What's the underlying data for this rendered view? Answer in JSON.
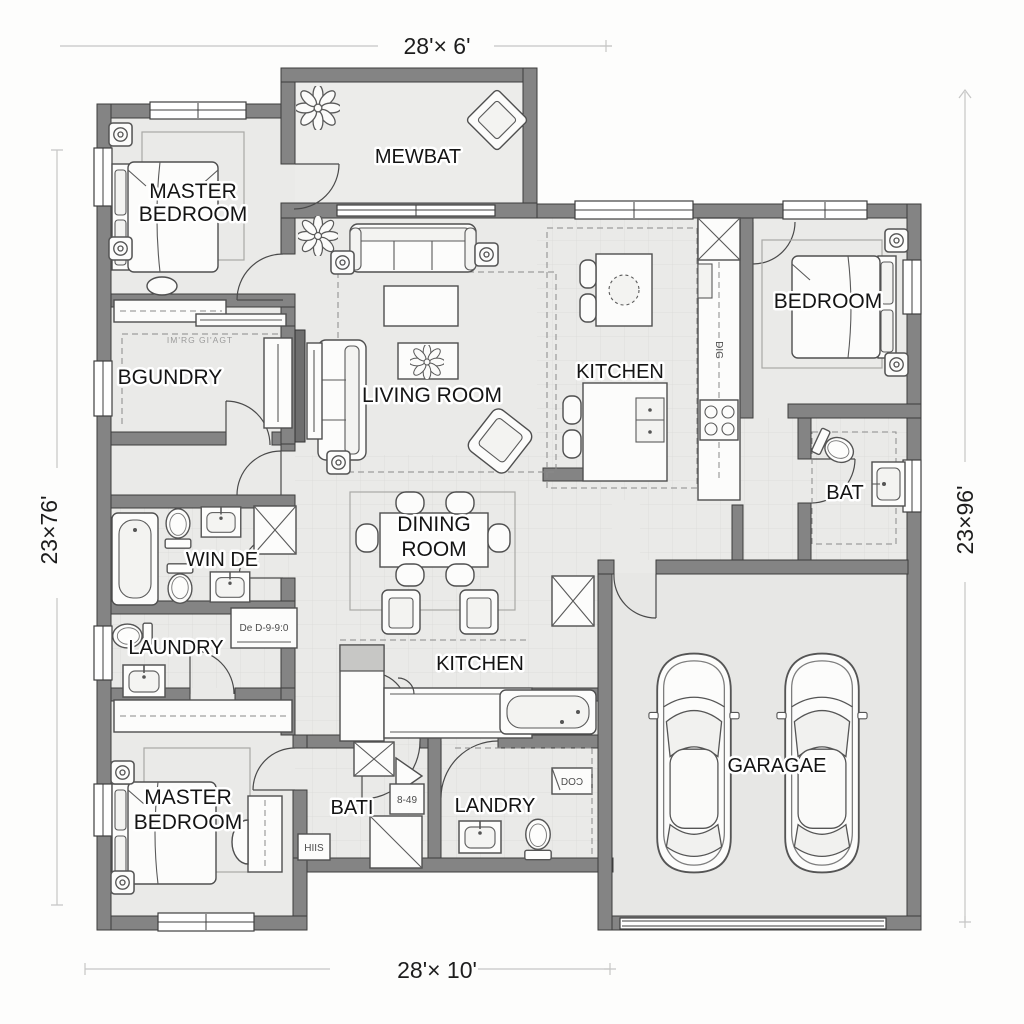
{
  "meta": {
    "type": "architectural-floor-plan",
    "style": "grayscale-blueprint"
  },
  "dimensions": {
    "top": "28'× 6'",
    "bottom": "28'× 10'",
    "left": "23×76'",
    "right": "23×96'"
  },
  "rooms": {
    "master_top": {
      "l1": "MASTER",
      "l2": "BEDROOM"
    },
    "patio": {
      "label": "MEWBAT"
    },
    "bedroom_right": {
      "label": "BEDROOM"
    },
    "utility_upper": {
      "label": "BGUNDRY"
    },
    "living": {
      "label": "LIVING ROOM"
    },
    "kitchen_upper": {
      "label": "KITCHEN"
    },
    "bath_right": {
      "label": "BAT"
    },
    "bath_mid": {
      "label": "WIN DE"
    },
    "dining": {
      "l1": "DINING",
      "l2": "ROOM"
    },
    "laundry_mid": {
      "label": "LAUNDRY"
    },
    "kitchen_lower": {
      "label": "KITCHEN"
    },
    "master_bottom": {
      "l1": "MASTER",
      "l2": "BEDROOM"
    },
    "bath_bottom": {
      "label": "BATI"
    },
    "laundry_bottom": {
      "label": "LANDRY"
    },
    "garage": {
      "label": "GARAGAE"
    }
  },
  "notes": {
    "closet_top": "IM'RG GI'AGT",
    "cabinet_mid": "De D-9-9:0",
    "cabinet_b1": "HIIS",
    "cabinet_b2": "8-49",
    "appliance": "DIG",
    "cabinet_b3": "DOƆ"
  },
  "colors": {
    "wall": "#848484",
    "wall_edge": "#3d3d3d",
    "floor": "#eaeae8",
    "floor_garage": "#e7e7e5",
    "floor_patio": "#ececea",
    "dim_line": "#c6c6c5",
    "text": "#141414"
  }
}
